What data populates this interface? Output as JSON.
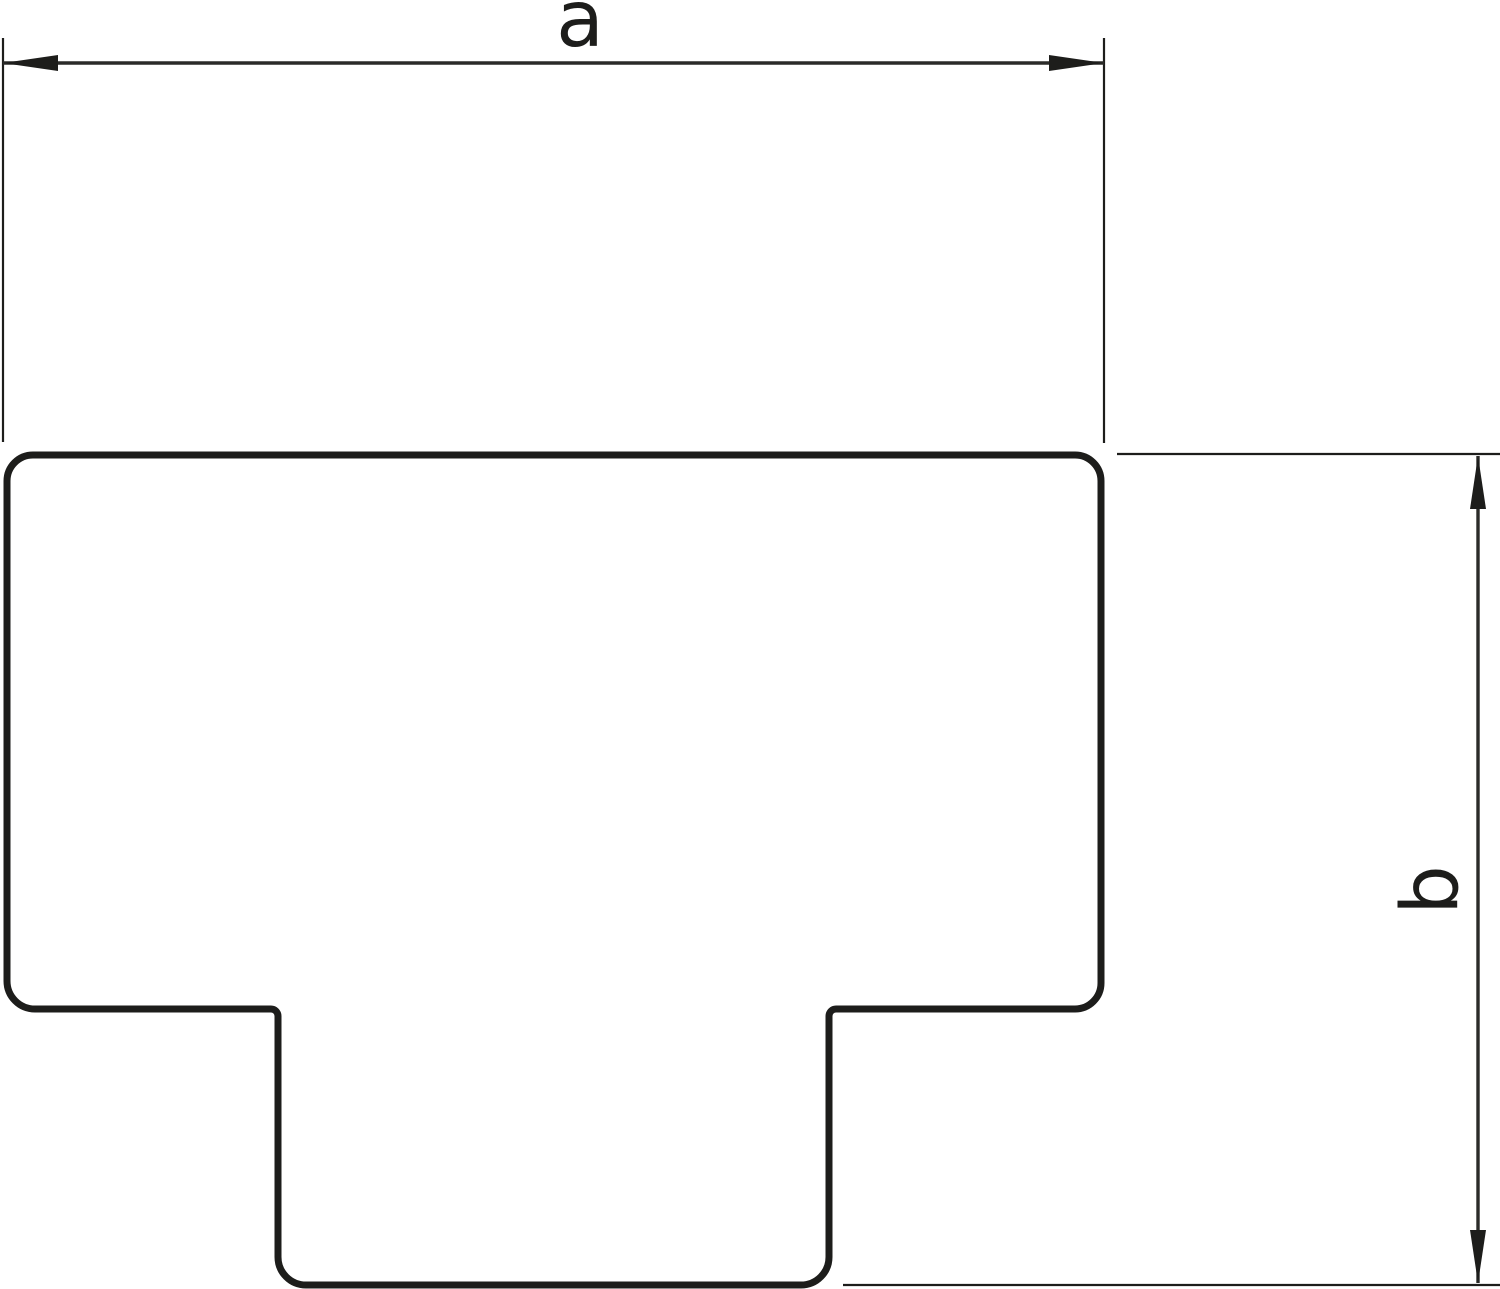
{
  "colors": {
    "background": "#ffffff",
    "line": "#1d1d1b"
  },
  "drawing": {
    "shape": "t-profile-outline",
    "dimensions": {
      "horizontal": {
        "label": "a"
      },
      "vertical": {
        "label": "b"
      }
    }
  }
}
